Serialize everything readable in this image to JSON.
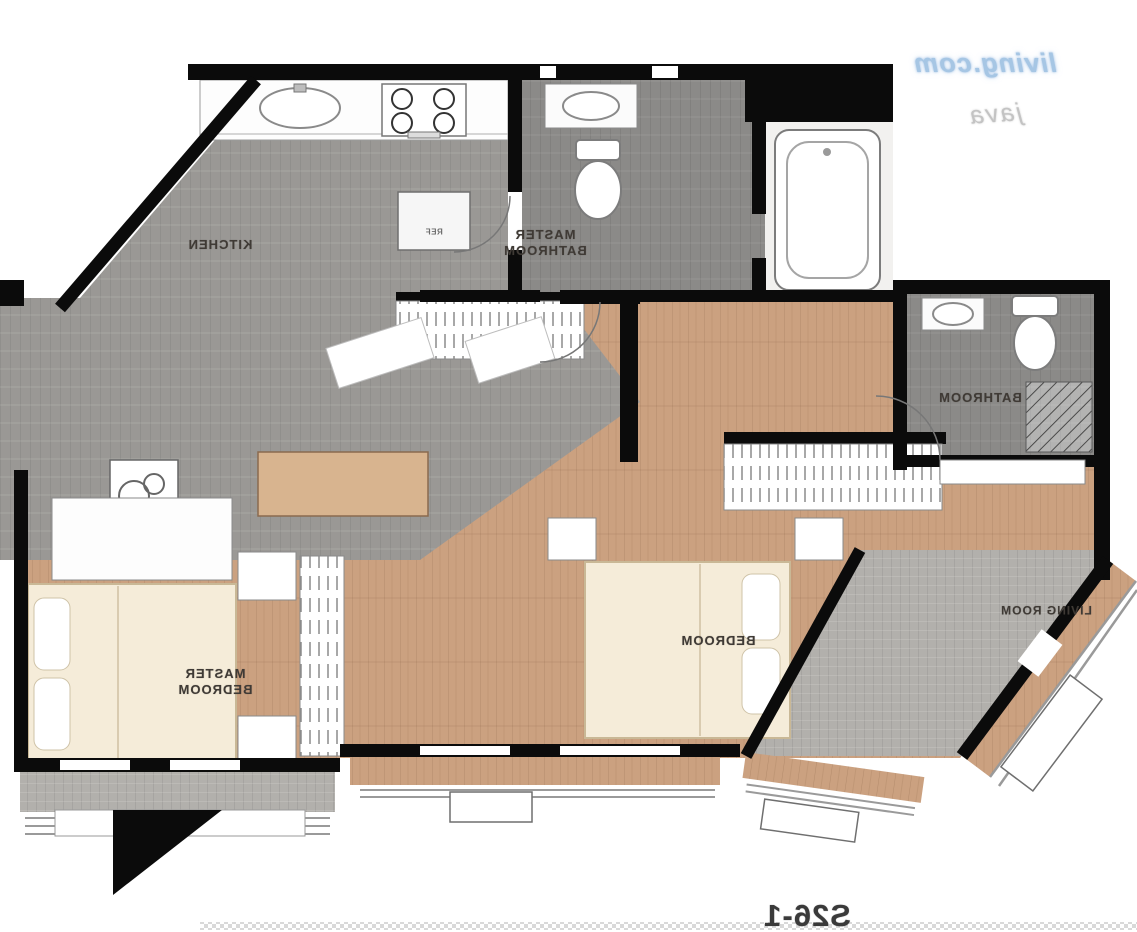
{
  "watermark": {
    "line1": "living.com",
    "line2": "java"
  },
  "unit_label": "S26-1",
  "rooms": [
    {
      "id": "kitchen",
      "label": "KITCHEN"
    },
    {
      "id": "master-bathroom",
      "label": "MASTER",
      "label2": "BATHROOM"
    },
    {
      "id": "bathroom",
      "label": "BATHROOM"
    },
    {
      "id": "bedroom",
      "label": "BEDROOM"
    },
    {
      "id": "master-bedroom",
      "label": "MASTER",
      "label2": "BEDROOM"
    },
    {
      "id": "living-room",
      "label": "LIVING ROOM"
    }
  ],
  "fixtures": {
    "fridge_label": "REF",
    "items": [
      "sink",
      "stove",
      "fridge",
      "toilet",
      "vanity",
      "bathtub",
      "shower",
      "washing-machine",
      "wardrobe",
      "desk",
      "bed",
      "pillow",
      "nightstand",
      "balcony-railing",
      "ac-unit"
    ]
  },
  "colors": {
    "wall": "#0b0b0b",
    "wood_floor": "#cba180",
    "tile_gray": "#9a9895",
    "tile_dark": "#8b8a88",
    "terrace_gray": "#b2b0ac",
    "bed_cream": "#f5ecd9",
    "watermark_blue": "#a6c6e4"
  }
}
